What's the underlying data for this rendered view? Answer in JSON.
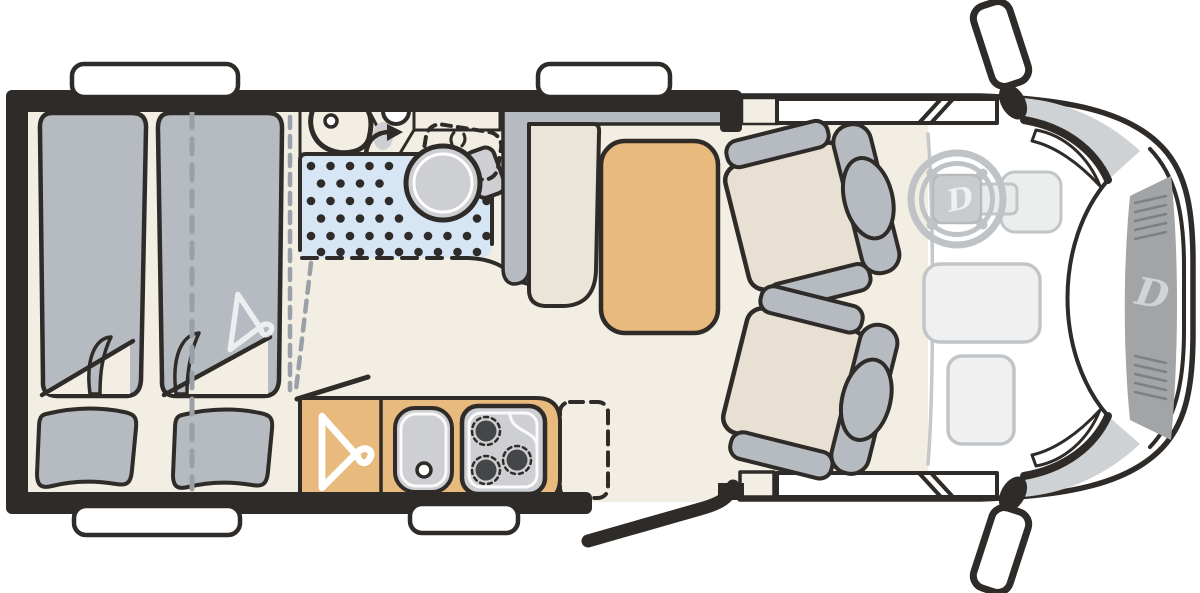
{
  "document": {
    "title": "Camper van floor plan — top view"
  },
  "branding": {
    "logo_letter": "D"
  },
  "colors": {
    "wall": "#2e2b28",
    "floor": "#f3eee4",
    "furniture_gray": "#b6bbc2",
    "cushion": "#e8e1d3",
    "bench": "#ebe4d8",
    "wood": "#e8ba7d",
    "shower": "#d7e6f5",
    "fixture_gray": "#cdcfd2",
    "counter_gray": "#d3d4d6",
    "shelf_gray": "#c9cbce",
    "cab_white": "#f7f7f5",
    "line_gray": "#9aa0a8",
    "dash_gray": "#c5c8cb",
    "grille_gray": "#a2a4a6",
    "grille_line": "#7e8082",
    "window_white": "#ffffff"
  },
  "legend": {
    "fixtures": [
      "twin-beds",
      "pillows",
      "bed-fold-corner",
      "clothes-hanger-marks",
      "washroom-basin",
      "swivel-toilet",
      "shower-tray",
      "dinette-bench",
      "dinette-table",
      "wardrobe",
      "kitchen-sink",
      "three-burner-hob",
      "worktop-extension-flap",
      "entry-door-open",
      "entry-step",
      "driver-swivel-seat",
      "passenger-swivel-seat",
      "steering-wheel",
      "dashboard",
      "windscreen-wipers",
      "side-mirrors",
      "front-grille",
      "windows"
    ]
  }
}
